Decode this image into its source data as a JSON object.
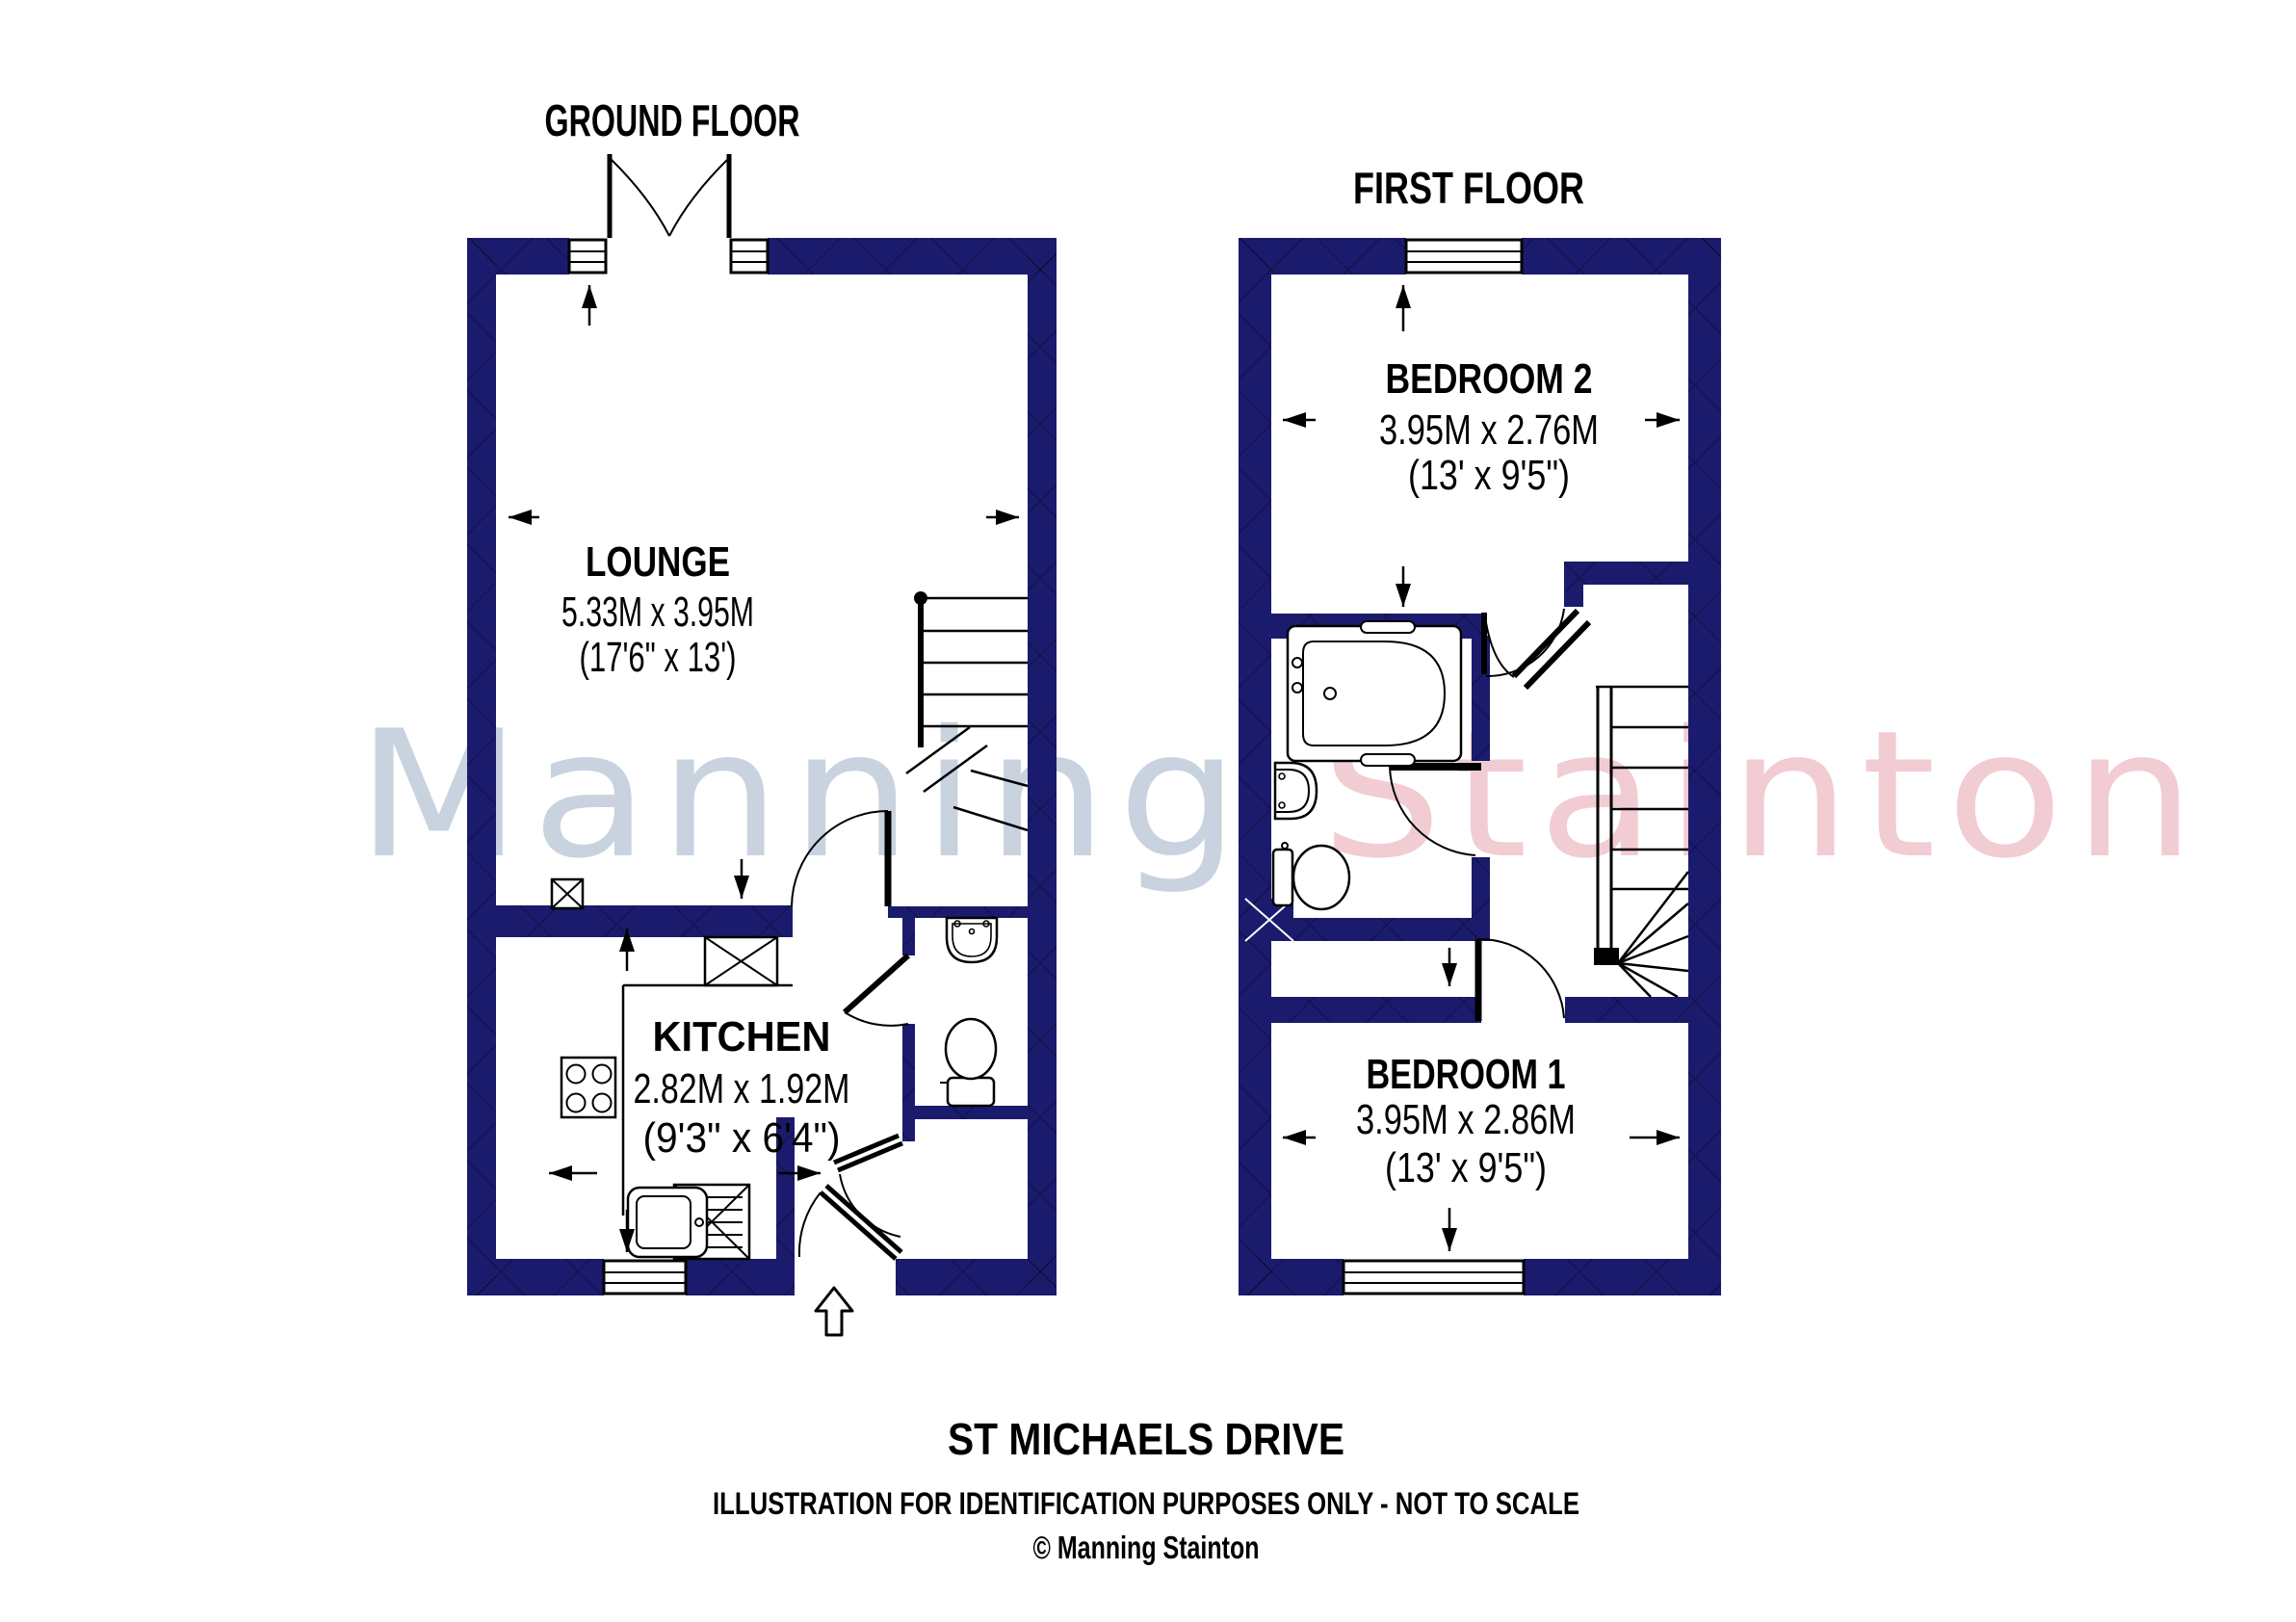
{
  "titles": {
    "ground": "GROUND FLOOR",
    "first": "FIRST FLOOR"
  },
  "watermark": {
    "part1": "Manning ",
    "part2": "Stainton",
    "color1": "#c9d3df",
    "color2": "#f2ccd3"
  },
  "colors": {
    "wall": "#1b1b6e",
    "line": "#000000",
    "background": "#ffffff"
  },
  "rooms": {
    "lounge": {
      "name": "LOUNGE",
      "metric": "5.33M x 3.95M",
      "imperial": "(17'6\" x 13')"
    },
    "kitchen": {
      "name": "KITCHEN",
      "metric": "2.82M x 1.92M",
      "imperial": "(9'3\" x 6'4\")"
    },
    "bedroom2": {
      "name": "BEDROOM 2",
      "metric": "3.95M x 2.76M",
      "imperial": "(13' x 9'5\")"
    },
    "bedroom1": {
      "name": "BEDROOM 1",
      "metric": "3.95M x 2.86M",
      "imperial": "(13' x 9'5\")"
    }
  },
  "footer": {
    "address": "ST MICHAELS DRIVE",
    "disclaimer": "ILLUSTRATION FOR IDENTIFICATION PURPOSES ONLY - NOT TO SCALE",
    "copyright": "© Manning Stainton"
  }
}
